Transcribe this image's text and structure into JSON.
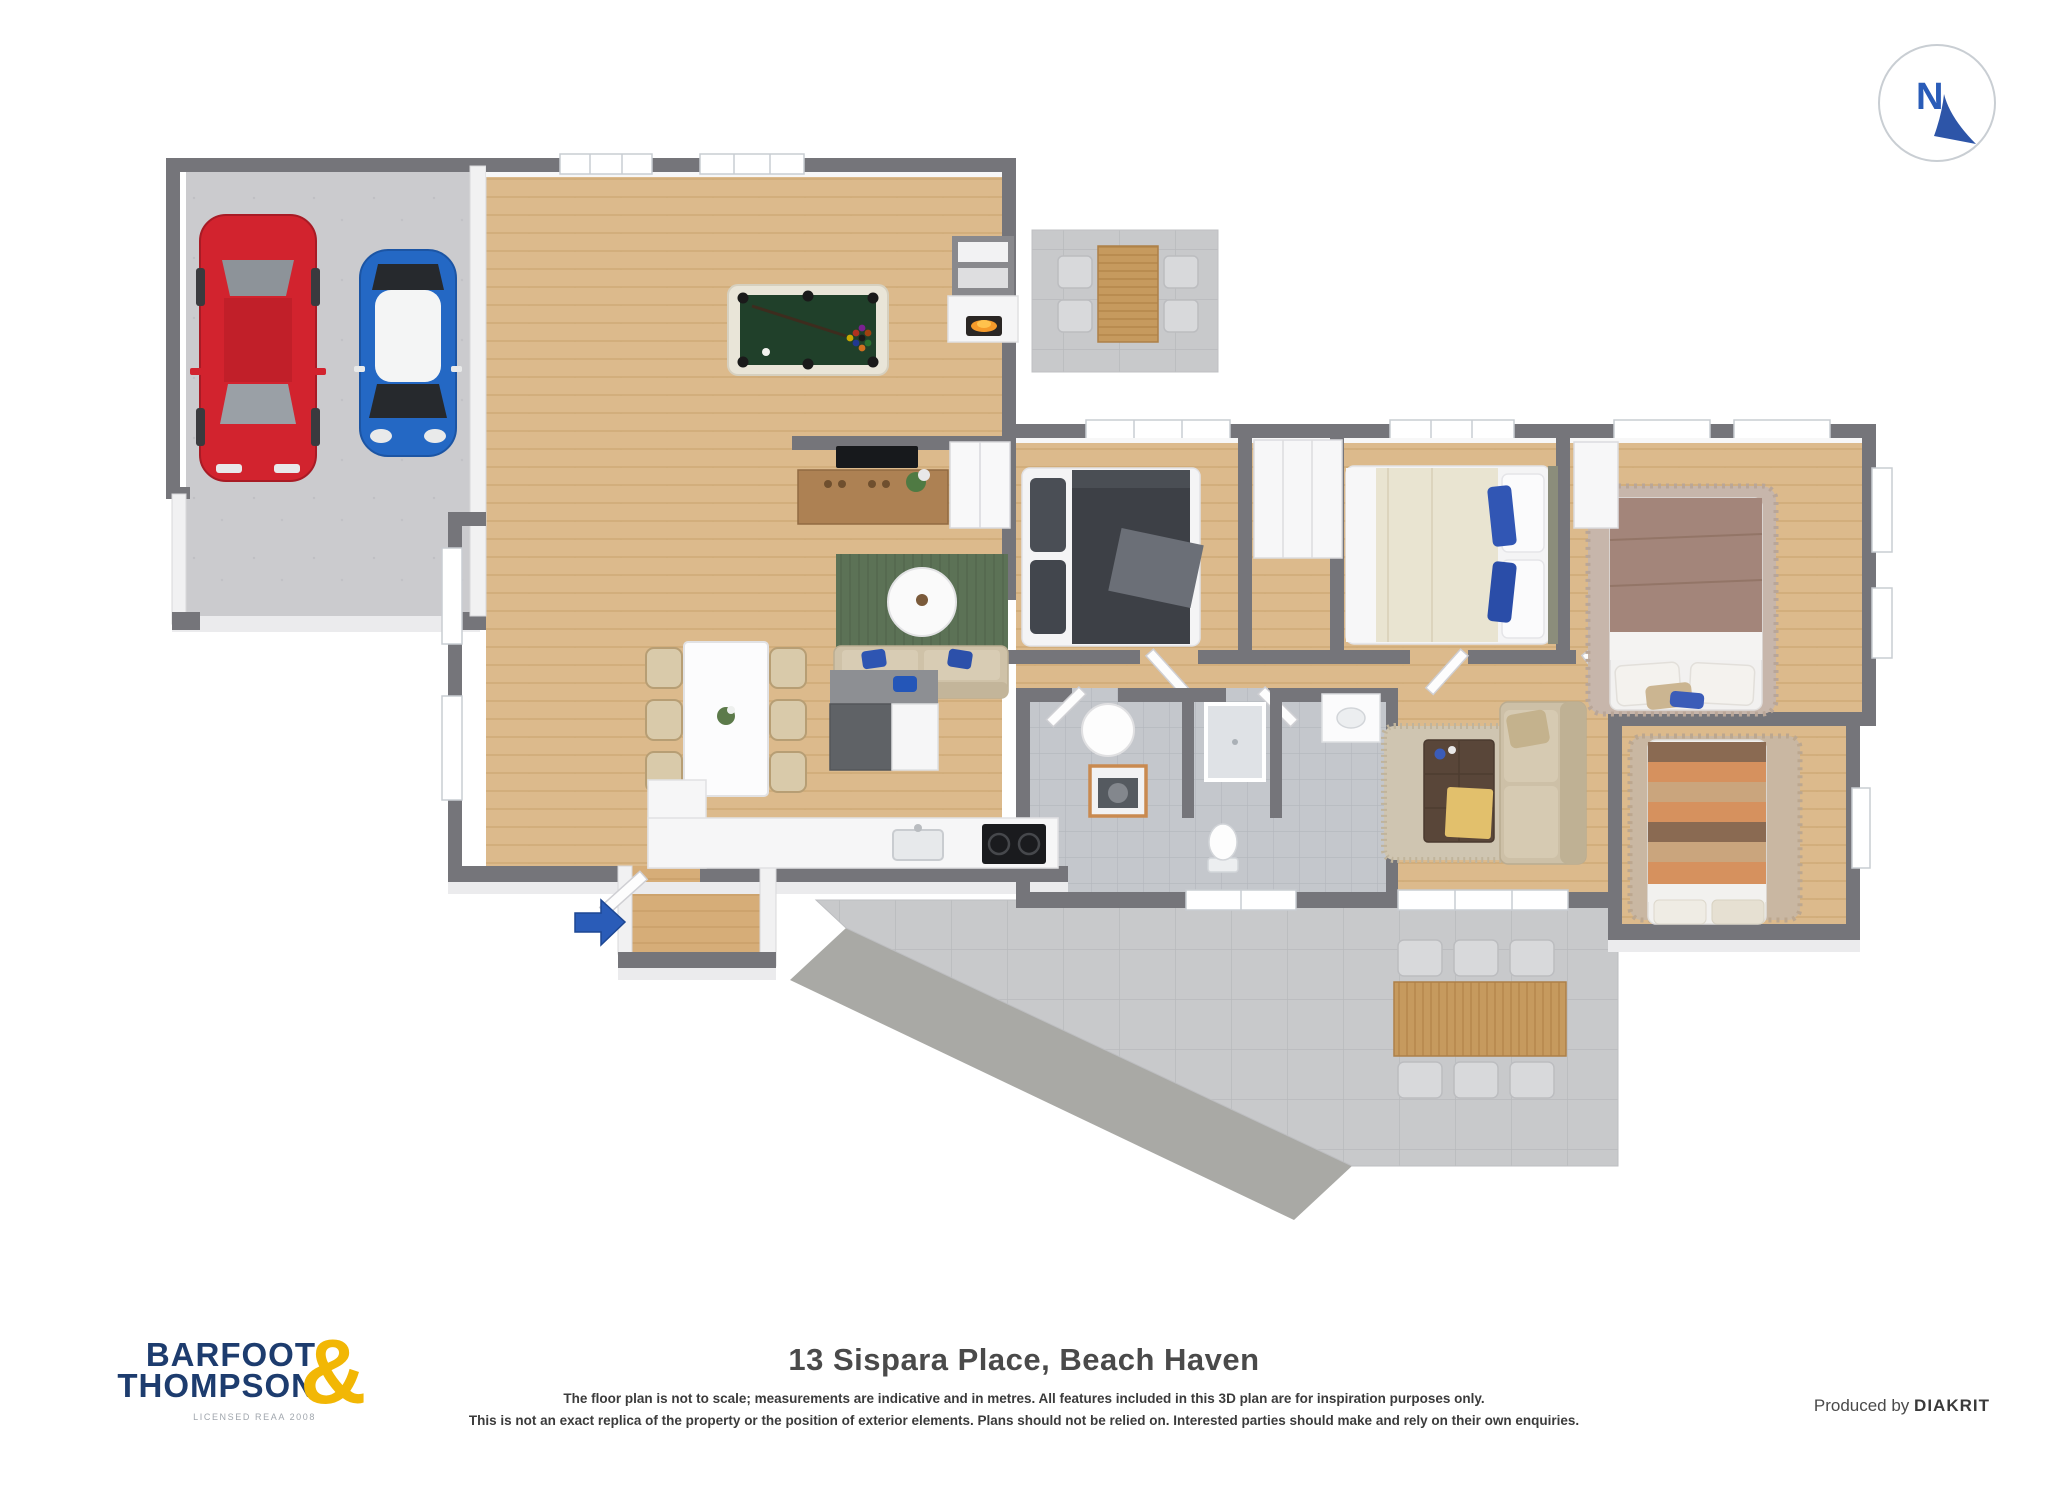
{
  "meta": {
    "kind": "3d-floor-plan-marketing-image"
  },
  "colors": {
    "brand-navy": "#1d3c6e",
    "brand-yellow": "#f2b705",
    "accent-blue": "#2a5cb8",
    "wall-dark": "#75757a",
    "wood-floor": "#dcba8c",
    "entry-wood": "#d6ad78",
    "concrete": "#cbcbce",
    "patio-tile": "#c8c9cb",
    "bath-tile": "#c4c7cc",
    "pool-felt": "#20402a",
    "rug-green": "#5c7256",
    "car-red": "#d2232e",
    "car-blue": "#2468c4"
  },
  "compass": {
    "letter": "N"
  },
  "footer": {
    "logo": {
      "line1": "BARFOOT",
      "line2": "THOMPSON",
      "ampersand": "&",
      "license": "LICENSED REAA 2008"
    },
    "title": "13 Sispara Place, Beach Haven",
    "disclaimer_line1": "The floor plan is not to scale; measurements are indicative and in metres. All features included in this 3D plan are for inspiration purposes only.",
    "disclaimer_line2": "This is not an exact replica of the property or the position of exterior elements. Plans should not be relied on. Interested parties should make and rely on their own enquiries.",
    "credit_prefix": "Produced by",
    "credit_brand": "DIAKRIT"
  },
  "floor_plan": {
    "rooms": [
      "garage",
      "games-room",
      "family-room",
      "dining-area",
      "kitchen",
      "entry",
      "hallway",
      "bedroom-1",
      "bedroom-2",
      "master-bedroom",
      "bedroom-3",
      "laundry",
      "bathroom",
      "living-room",
      "patio-top",
      "patio-main"
    ],
    "furniture": [
      "red-car",
      "blue-mini-car",
      "pool-table",
      "fireplace",
      "wall-tv",
      "tv-sideboard",
      "cupboard",
      "green-rug",
      "round-side-table",
      "two-seat-sofa",
      "dining-table",
      "dining-chairs",
      "kitchen-island",
      "fridge",
      "kitchen-sink",
      "cooktop",
      "bed-dark-duvet",
      "bed-cream-duvet",
      "bed-brown-duvet",
      "bed-striped-duvet",
      "wardrobe",
      "couch",
      "coffee-table",
      "shag-rug",
      "laundry-tub",
      "washing-machine",
      "shower",
      "toilet",
      "vanity",
      "outdoor-table-small",
      "outdoor-table-large",
      "outdoor-chairs",
      "entry-arrow"
    ]
  }
}
